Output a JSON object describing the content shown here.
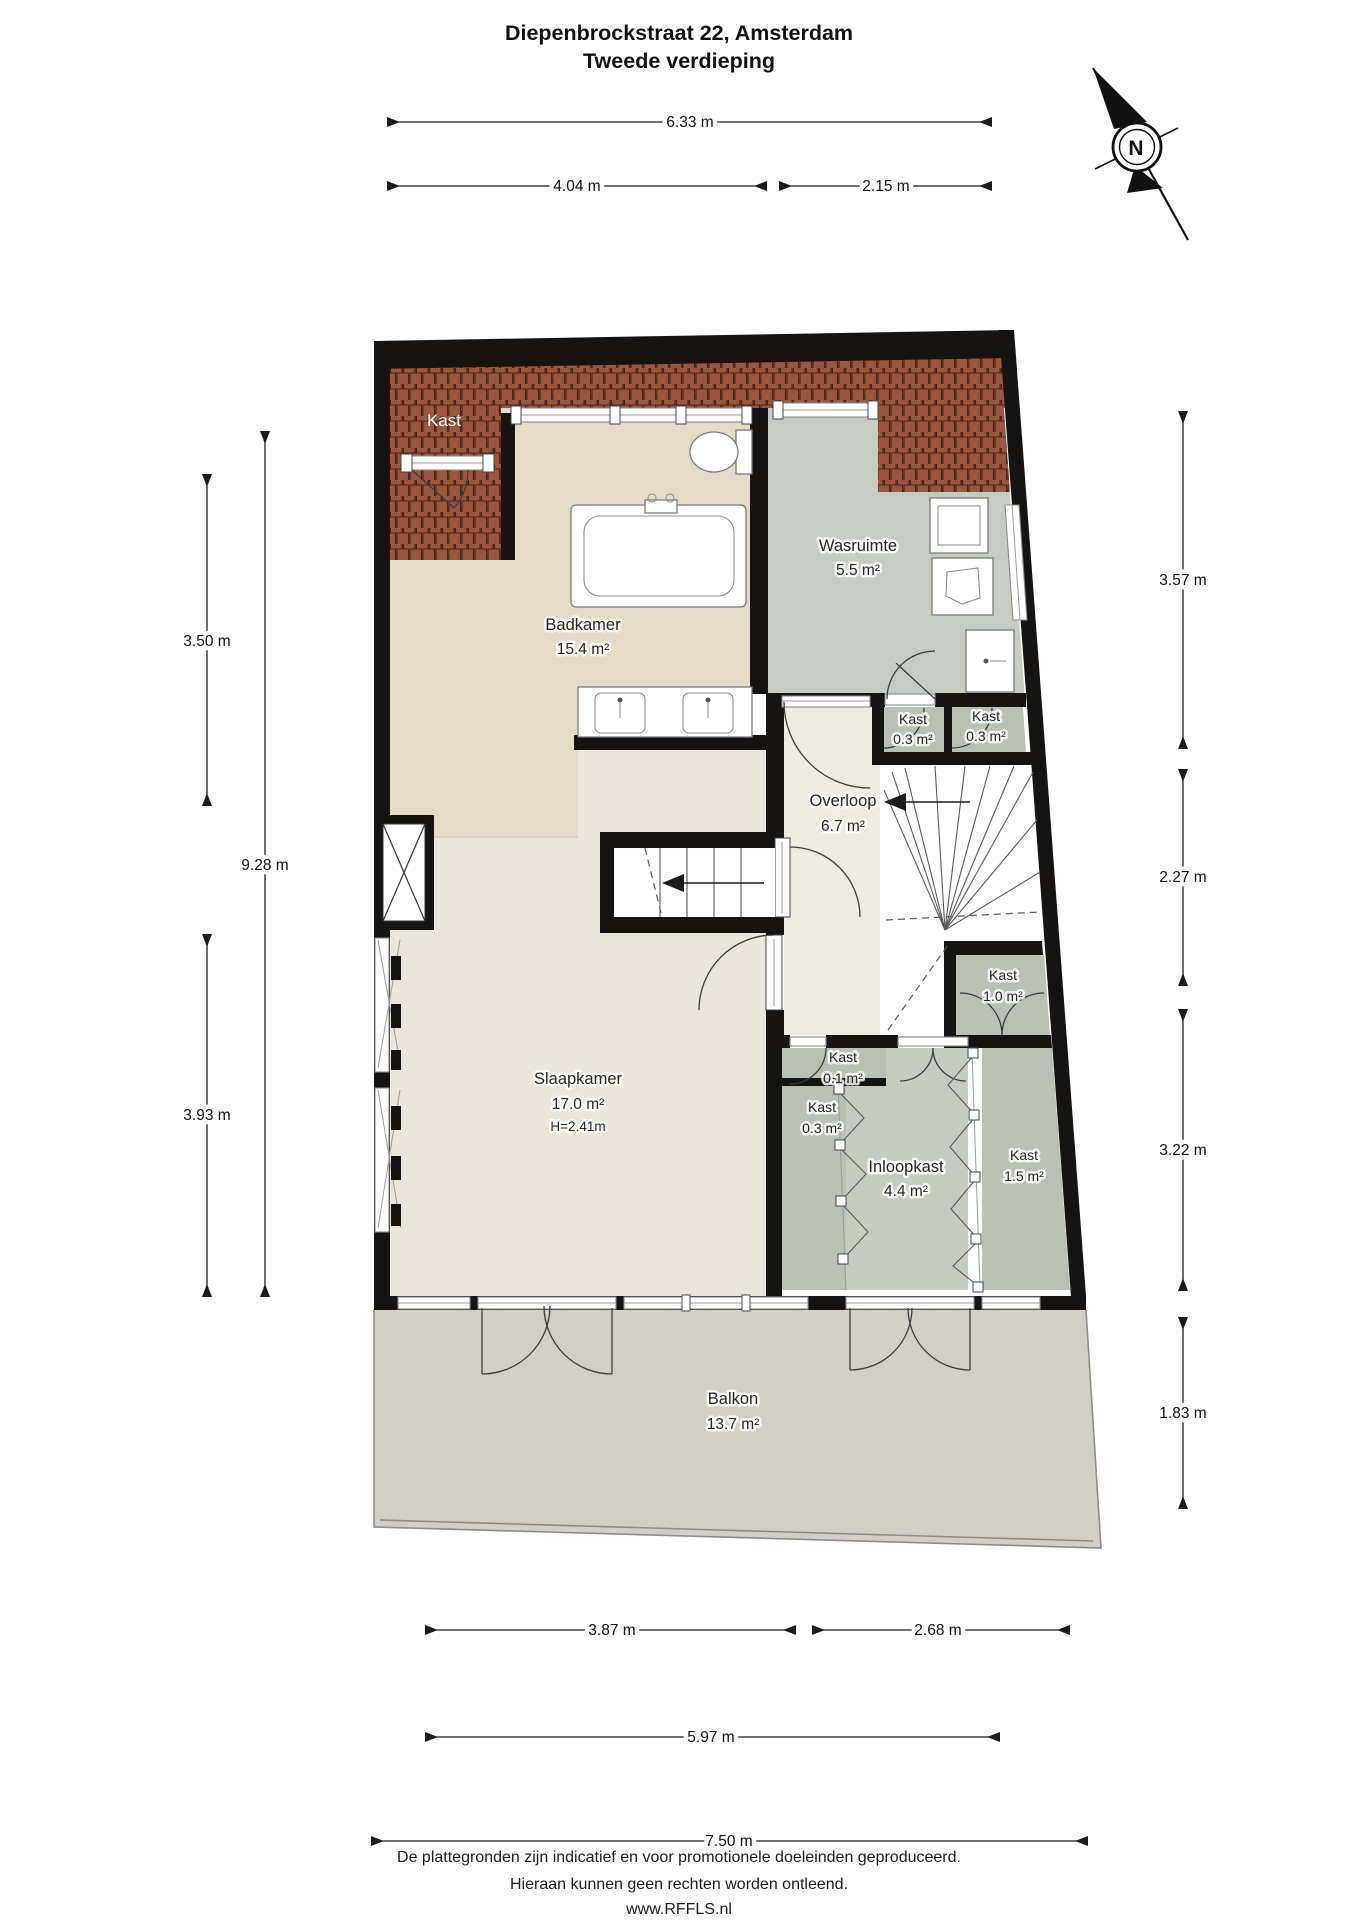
{
  "title": {
    "line1": "Diepenbrockstraat 22, Amsterdam",
    "line2": "Tweede verdieping"
  },
  "compass": {
    "north_label": "N"
  },
  "rooms": {
    "roof_kast": {
      "name": "Kast"
    },
    "badkamer": {
      "name": "Badkamer",
      "area": "15.4 m²"
    },
    "wasruimte": {
      "name": "Wasruimte",
      "area": "5.5 m²"
    },
    "kast_top_a": {
      "name": "Kast",
      "area": "0.3 m²"
    },
    "kast_top_b": {
      "name": "Kast",
      "area": "0.3 m²"
    },
    "overloop": {
      "name": "Overloop",
      "area": "6.7 m²"
    },
    "kast_10": {
      "name": "Kast",
      "area": "1.0 m²"
    },
    "kast_01": {
      "name": "Kast",
      "area": "0.1 m²"
    },
    "kast_03_laag": {
      "name": "Kast",
      "area": "0.3 m²"
    },
    "slaapkamer": {
      "name": "Slaapkamer",
      "area": "17.0 m²",
      "ceiling_height": "H=2.41m"
    },
    "inloopkast": {
      "name": "Inloopkast",
      "area": "4.4 m²"
    },
    "kast_15": {
      "name": "Kast",
      "area": "1.5 m²"
    },
    "balkon": {
      "name": "Balkon",
      "area": "13.7 m²"
    }
  },
  "dimensions": {
    "top": [
      {
        "label": "6.33 m"
      },
      {
        "label": "4.04 m"
      },
      {
        "label": "2.15 m"
      }
    ],
    "left": [
      {
        "label": "3.50 m"
      },
      {
        "label": "9.28 m"
      },
      {
        "label": "3.93 m"
      }
    ],
    "right": [
      {
        "label": "3.57 m"
      },
      {
        "label": "2.27 m"
      },
      {
        "label": "3.22 m"
      },
      {
        "label": "1.83 m"
      }
    ],
    "bottom": [
      {
        "label": "3.87 m"
      },
      {
        "label": "2.68 m"
      },
      {
        "label": "5.97 m"
      },
      {
        "label": "7.50 m"
      }
    ]
  },
  "footer": {
    "line1": "De plattegronden zijn indicatief en voor promotionele doeleinden geproduceerd.",
    "line2": "Hieraan kunnen geen rechten worden ontleend.",
    "line3": "www.RFFLS.nl"
  },
  "colors": {
    "wall": "#151413",
    "badkamer_floor": "#e5dcc8",
    "slaapkamer_floor": "#eae6d9",
    "overloop_floor": "#eeebe1",
    "wasruimte_floor": "#c7ccc2",
    "kast_floor": "#bac0b3",
    "inloopkast_floor": "#c6cbbf",
    "balkon_floor": "#d2cfc4",
    "roof_tile": "#9a5740",
    "roof_tile_outline": "#4a2316",
    "roof_base": "#6e3a29"
  }
}
